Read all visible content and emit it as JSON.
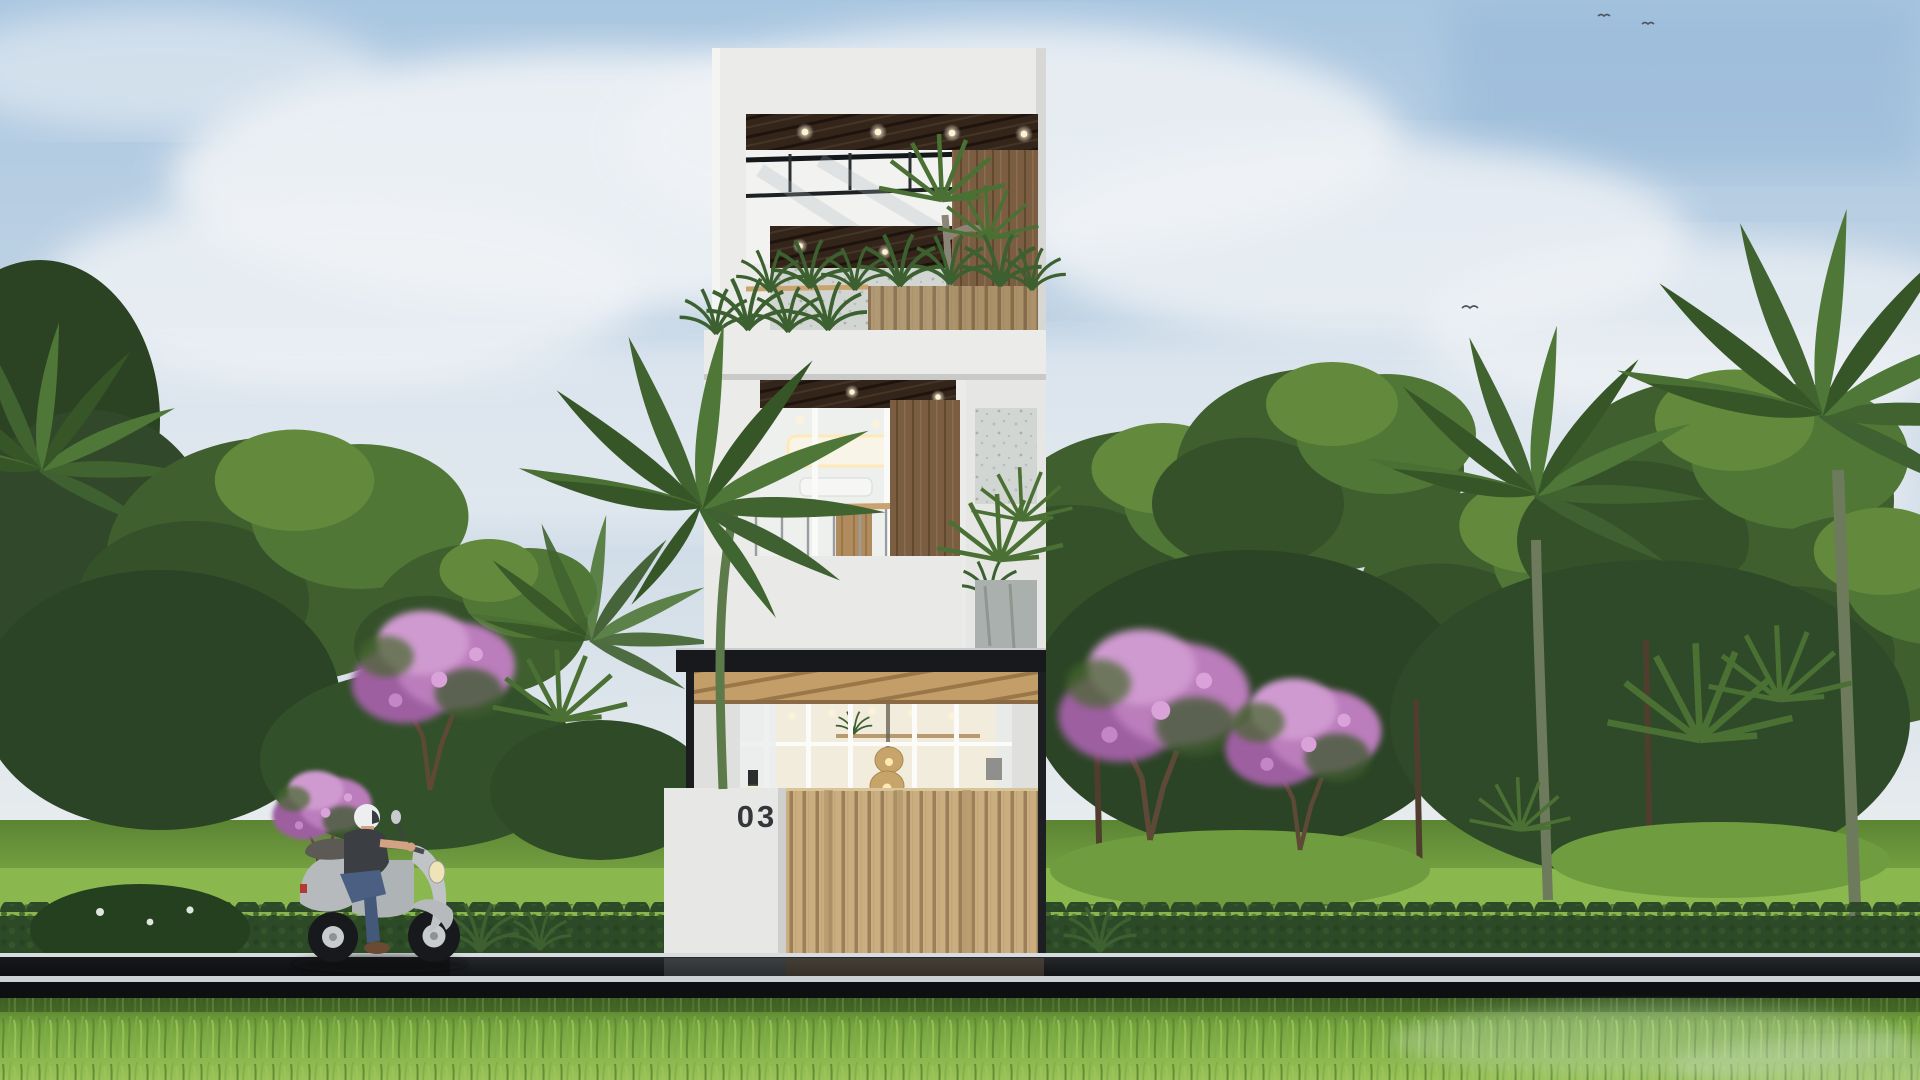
{
  "scene": {
    "description": "daytime-architectural-exterior-render-of-narrow-modern-townhouse",
    "house_number": "03"
  },
  "palette": {
    "sky_top": "#a9c6e0",
    "sky_horizon": "#eef0f0",
    "cloud_white": "#f0f3f6",
    "building_white": "#ebecea",
    "soffit_wood_dark": "#33251a",
    "wood_plank_brown": "#7b5d42",
    "wood_light_gate": "#cbae80",
    "canopy_black": "#17191c",
    "foliage_dark": "#2b4425",
    "foliage_mid": "#3f5f2e",
    "foliage_light": "#629038",
    "lawn_green": "#7fae49",
    "hedge_green": "#2c4a27",
    "flower_pink": "#bb7dbc",
    "road_asphalt": "#17191d",
    "road_line_white": "#d8dcde",
    "foreground_grass": "#85b14b",
    "scooter_body_gray": "#b7bcbe",
    "rider_shirt_gray": "#3b3e43",
    "rider_jeans_blue": "#4b5f82",
    "helmet_white": "#eceeef",
    "interior_glow": "#f6eedd",
    "downlight_warm": "#ffedb8"
  }
}
